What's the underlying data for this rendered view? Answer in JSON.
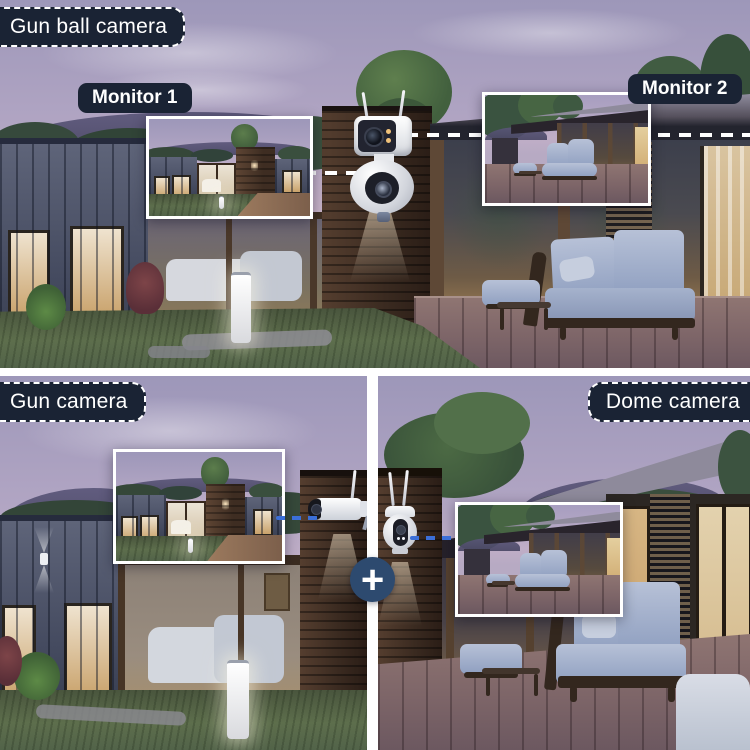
{
  "labels": {
    "gun_ball_camera": "Gun ball camera",
    "monitor_1": "Monitor 1",
    "monitor_2": "Monitor 2",
    "gun_camera": "Gun camera",
    "dome_camera": "Dome camera",
    "plus": "+"
  },
  "icons": {
    "dual_camera": "dual-lens-gun-ball-camera-icon",
    "bullet_camera": "gun-bullet-camera-icon",
    "dome_camera": "dome-ptz-camera-icon",
    "plus_badge": "plus-icon"
  },
  "colors": {
    "label_background": "#1a2334",
    "label_text": "#ffffff",
    "label_dash_border": "#ffffff",
    "connector_white": "#ffffff",
    "connector_blue": "#3b6fd8",
    "plus_badge_background": "#2d4a6f",
    "divider": "#ffffff"
  }
}
